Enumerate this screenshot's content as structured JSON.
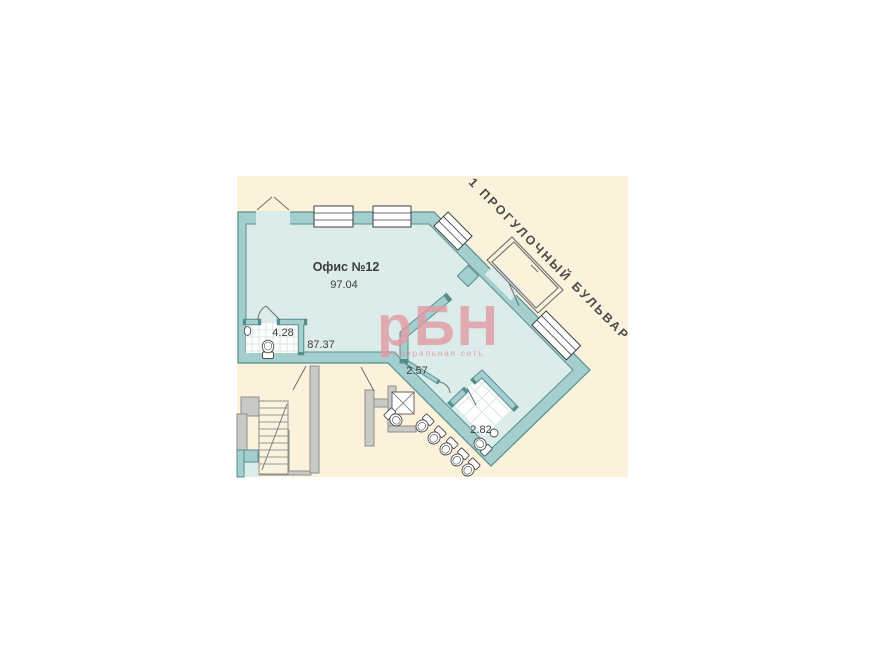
{
  "title": "Floor plan — Офис №12",
  "plan": {
    "unit": {
      "name_label": "Офис №12",
      "total_area": "97.04"
    },
    "areas": {
      "main_room": "87.37",
      "bathroom": "4.28",
      "vestibule": "2.57",
      "wc": "2.82"
    },
    "street_label": "1 ПРОГУЛОЧНЫЙ БУЛЬВАР"
  },
  "watermark": {
    "logo": "рБН",
    "tagline": "Федеральная сеть"
  },
  "colors": {
    "page_background": "#ffffff",
    "plan_background": "#fbf2db",
    "room_fill": "#dcecea",
    "wall_fill": "#a5cfce",
    "wall_outline": "#568e8e",
    "gray_wall": "#c9c9c5",
    "label_text": "#3c3c3c",
    "street_text": "#4c4c4c",
    "watermark_pink": "#e19aa4"
  }
}
